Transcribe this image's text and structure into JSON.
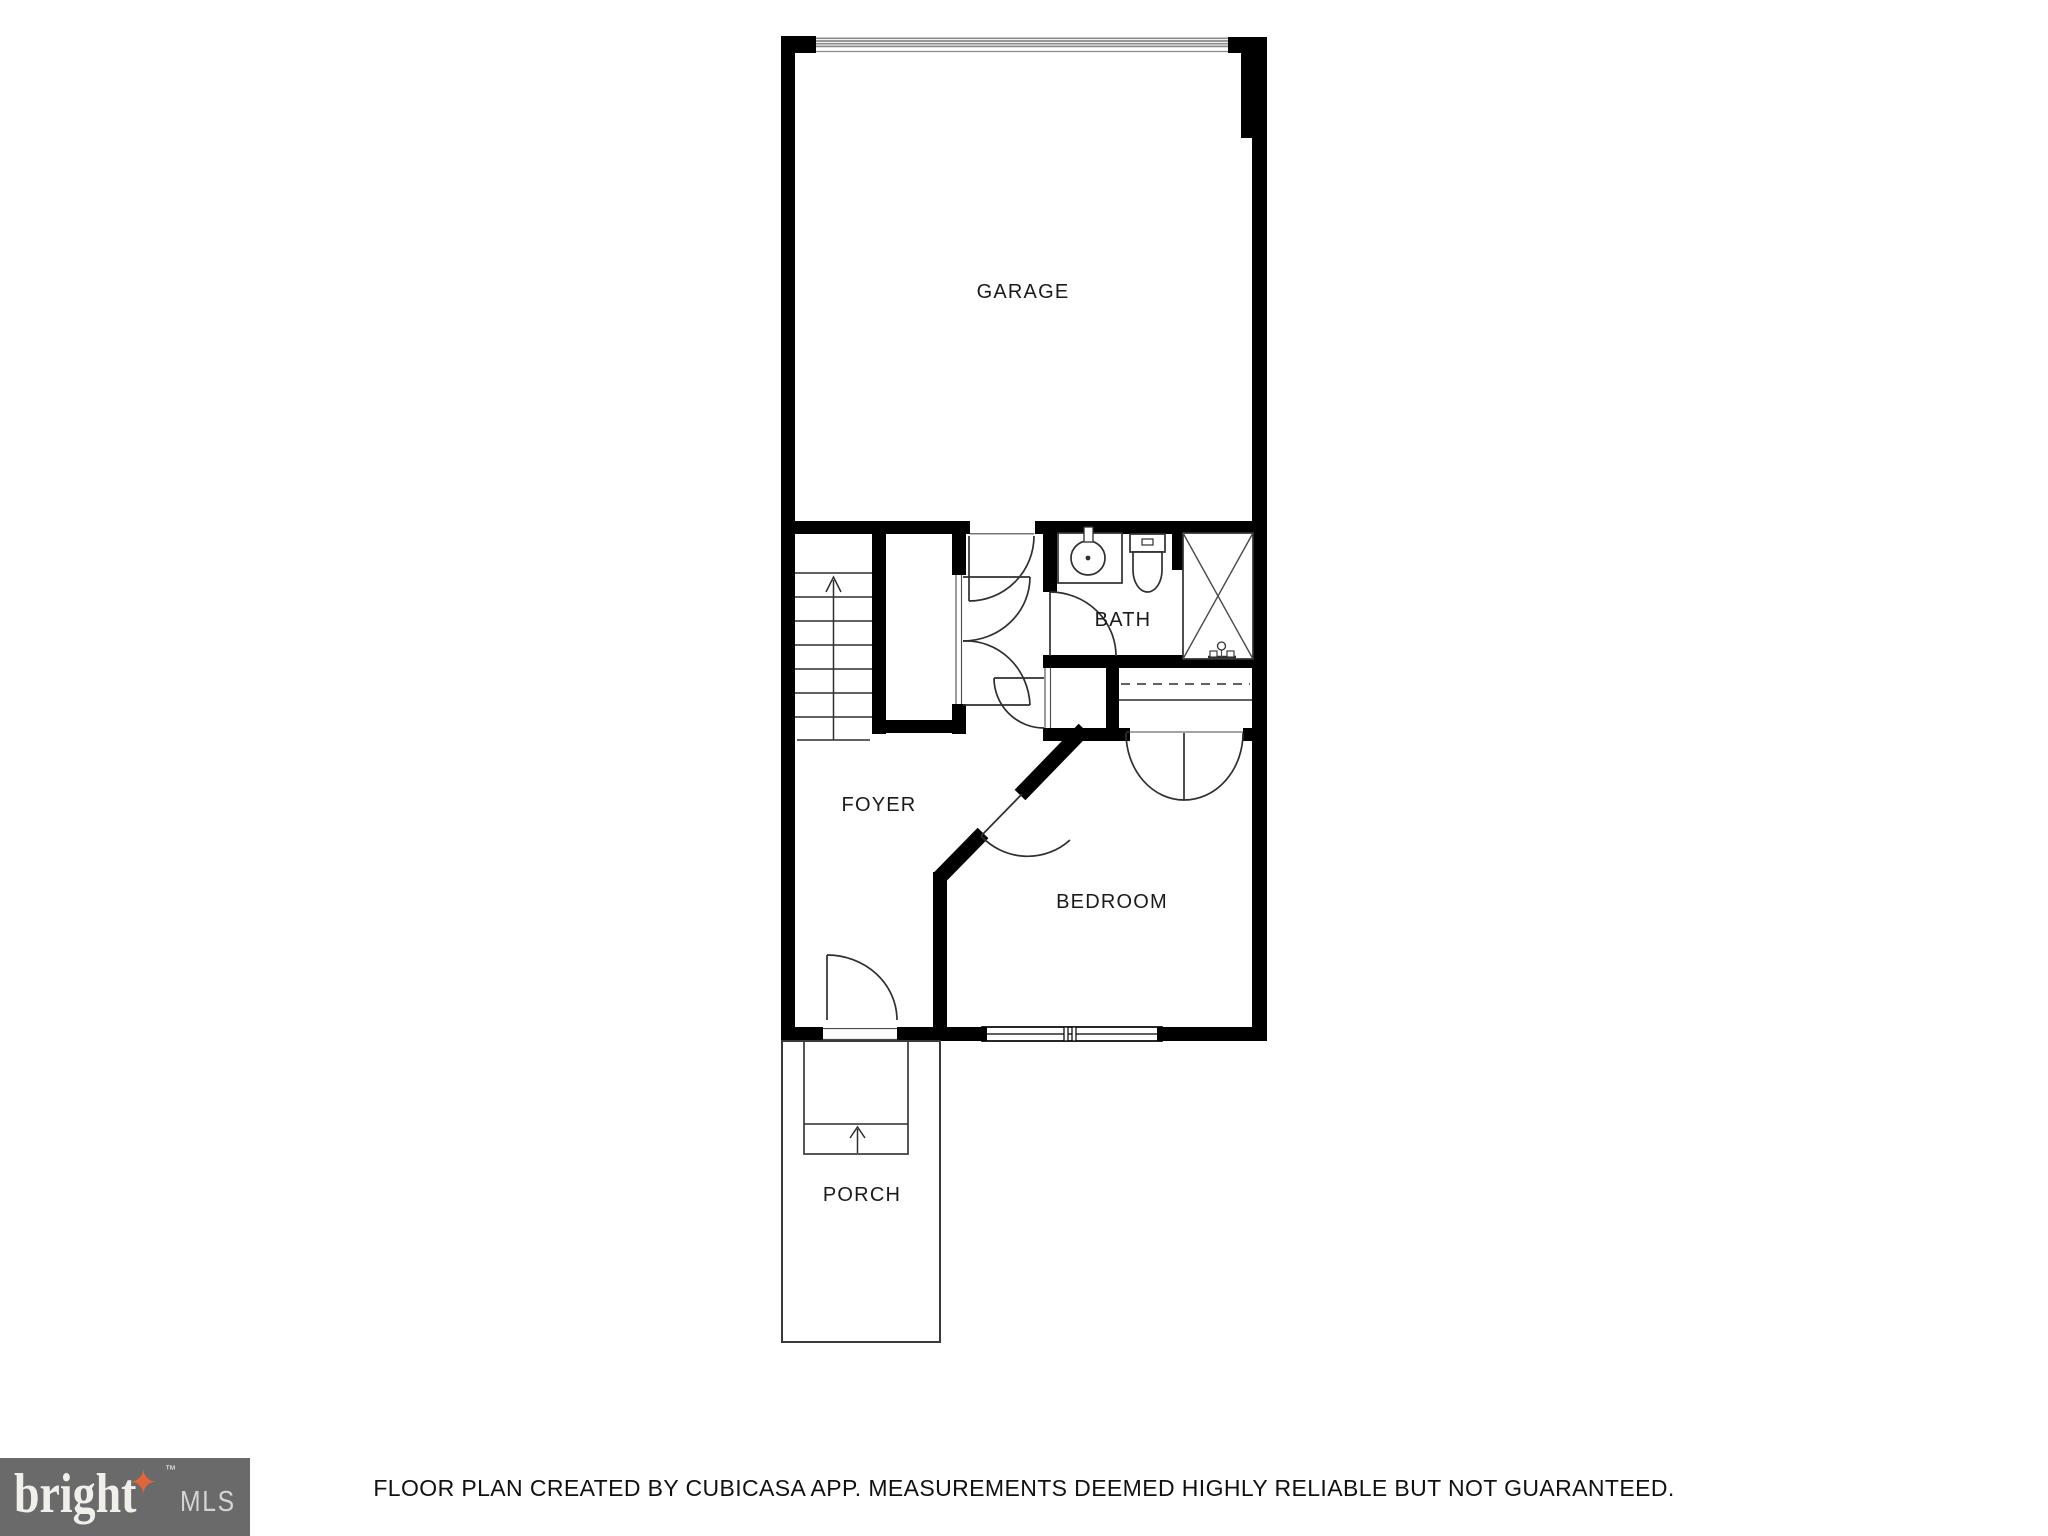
{
  "rooms": {
    "garage": {
      "label": "GARAGE"
    },
    "bath": {
      "label": "BATH"
    },
    "foyer": {
      "label": "FOYER"
    },
    "bedroom": {
      "label": "BEDROOM"
    },
    "porch": {
      "label": "PORCH"
    }
  },
  "symbols": {
    "stairs_direction": "up-arrow",
    "porch_steps_direction": "up-arrow",
    "garage_door": "horizontal-striped-band",
    "shower": "crossed-box",
    "closet_rod": "dashed-line"
  },
  "footer": {
    "disclaimer": "FLOOR PLAN CREATED BY CUBICASA APP. MEASUREMENTS DEEMED HIGHLY RELIABLE BUT NOT GUARANTEED."
  },
  "logo": {
    "brand": "bright",
    "star": "✦",
    "trademark": "™",
    "suffix": "MLS"
  },
  "colors": {
    "wall": "#000000",
    "thin_line": "#2f2f2f",
    "garage_door_line": "#8a8a8a",
    "label_text": "#1b1b1b",
    "footer_text": "#111111",
    "logo_box": "#6a6a6a",
    "logo_star": "#e0663a",
    "logo_brand_text": "#f0efe9",
    "logo_suffix_text": "#d4d4d2"
  }
}
